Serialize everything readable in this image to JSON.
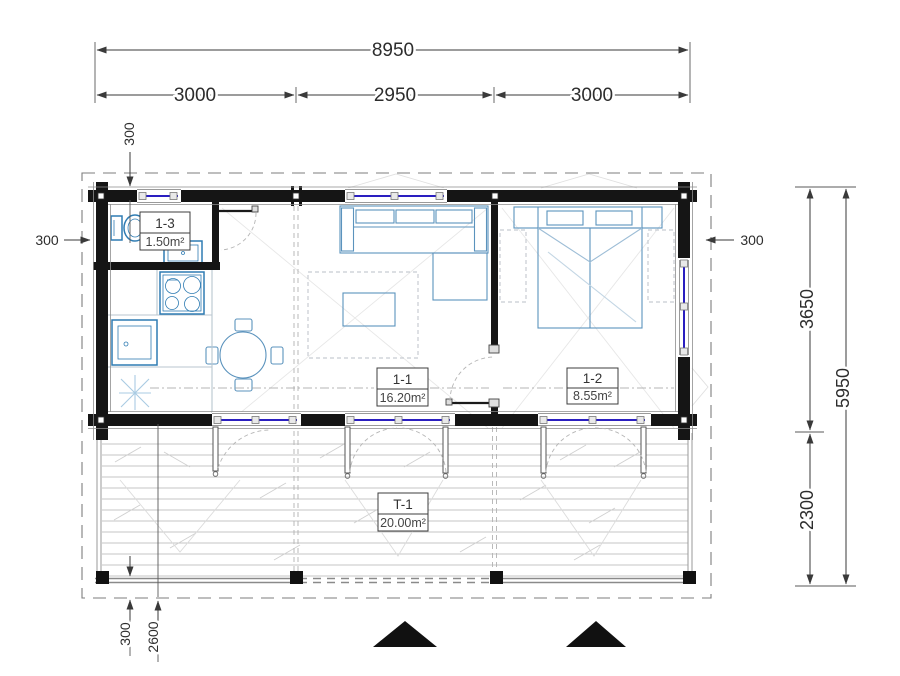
{
  "dimensions": {
    "overall_width": "8950",
    "module_left": "3000",
    "module_mid": "2950",
    "module_right": "3000",
    "offset_top": "300",
    "offset_left": "300",
    "offset_right": "300",
    "house_depth": "3650",
    "overall_depth": "5950",
    "terrace_depth": "2300",
    "terrace_offset": "300",
    "terrace_span": "2600"
  },
  "rooms": {
    "bathroom": {
      "id": "1-3",
      "area": "1.50m²"
    },
    "living": {
      "id": "1-1",
      "area": "16.20m²"
    },
    "bedroom": {
      "id": "1-2",
      "area": "8.55m²"
    },
    "terrace": {
      "id": "T-1",
      "area": "20.00m²"
    }
  },
  "colors": {
    "wall": "#151515",
    "glazing": "#2a1ec0",
    "furniture": "#5b93bd",
    "fixture": "#2f7cb3",
    "dimension": "#3a3a3a",
    "entrance_marker": "#111111",
    "deck": "#c4c4c4"
  }
}
